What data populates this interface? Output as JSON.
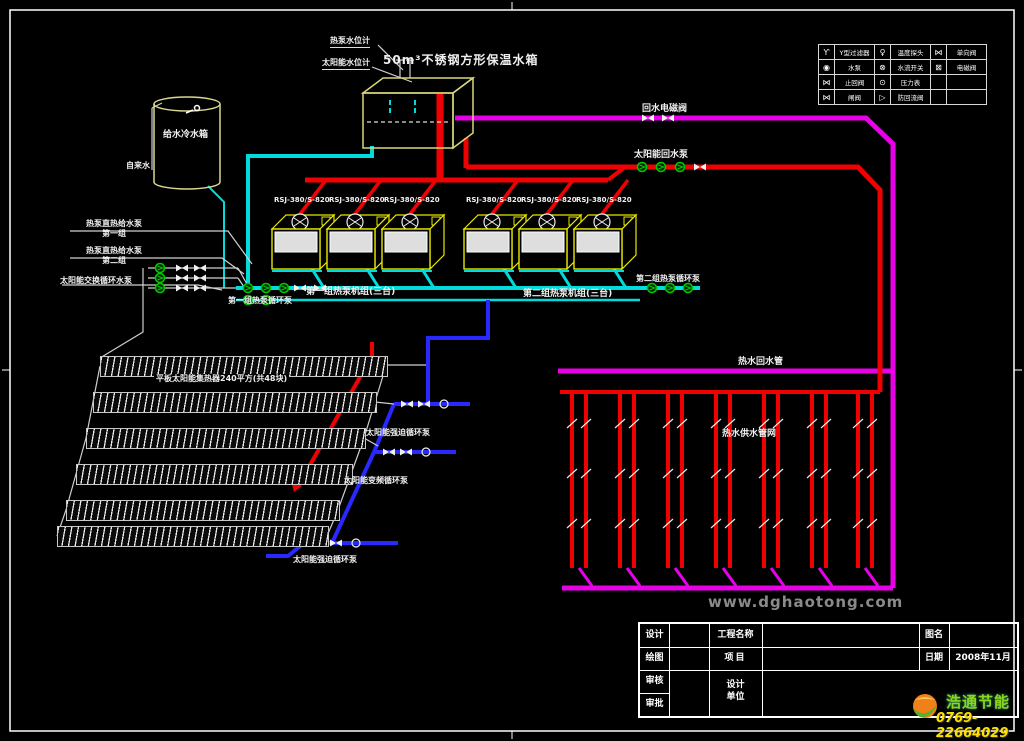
{
  "labels": {
    "tank_main": "50m³不锈钢方形保温水箱",
    "callout_hp": "热泵水位计",
    "callout_solar": "太阳能水位计",
    "cold_tank": "给水冷水箱",
    "tap_water": "自来水",
    "group1_units": "第一组热泵机组(三台)",
    "group1_pump": "第一组热泵循环泵",
    "group2_units": "第二组热泵机组(三台)",
    "group2_pump": "第二组热泵循环泵",
    "feed_pump_1": "热泵直热给水泵\n第一组",
    "feed_pump_2": "热泵直热给水泵\n第二组",
    "solar_exchange_pump": "太阳能交换循环水泵",
    "collector": "平板太阳能集热器240平方(共48块)",
    "solar_forced_pump_1": "太阳能强迫循环泵",
    "solar_vfd_pump": "太阳能变频循环泵",
    "solar_forced_pump_2": "太阳能强迫循环泵",
    "return_solenoid": "回水电磁阀",
    "solar_return_pump": "太阳能回水泵",
    "hw_return": "热水回水管",
    "hw_supply": "热水供水管网"
  },
  "units": [
    {
      "model": "RSJ-380/S-820"
    },
    {
      "model": "RSJ-380/S-820"
    },
    {
      "model": "RSJ-380/S-820"
    },
    {
      "model": "RSJ-380/S-820"
    },
    {
      "model": "RSJ-380/S-820"
    },
    {
      "model": "RSJ-380/S-820"
    }
  ],
  "legend": {
    "rows": [
      [
        "Ƴ",
        "Y型过滤器",
        "♀",
        "温度探头",
        "⋈",
        "单向阀"
      ],
      [
        "◉",
        "水泵",
        "⊗",
        "水流开关",
        "⊠",
        "电磁阀"
      ],
      [
        "⋈",
        "止回阀",
        "⊙",
        "压力表",
        "",
        ""
      ],
      [
        "⋈",
        "闸阀",
        "▷",
        "防回流阀",
        "",
        ""
      ]
    ]
  },
  "title_block": {
    "left_rows": [
      "设计",
      "绘图",
      "审核",
      "审批"
    ],
    "project": "工程名称",
    "item": "项目",
    "design_unit": "设计\n单位",
    "drawing_name": "图名",
    "date": "日期",
    "date_value": "2008年11月"
  },
  "branding": {
    "watermark": "www.dghaotong.com",
    "company": "浩通节能",
    "phone": "0769-22664029"
  },
  "colors": {
    "hot_pipe": "#f00000",
    "return_pipe": "#e800e8",
    "cold_pipe": "#00dcdc",
    "solar_pipe": "#2828ff",
    "pump_symbol": "#00c800",
    "tank_outline": "#d8d878"
  }
}
